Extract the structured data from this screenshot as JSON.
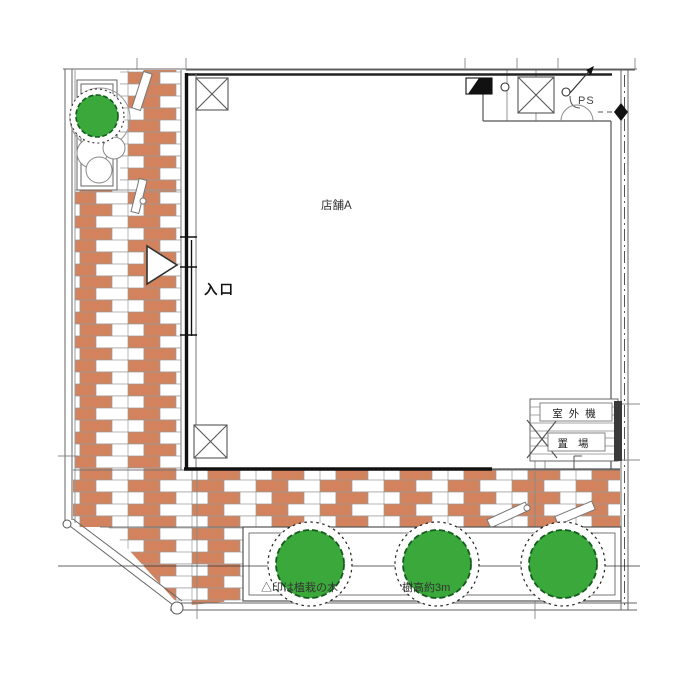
{
  "labels": {
    "room": "店舗A",
    "entrance": "入口",
    "pipe_shaft": "PS",
    "outdoor_unit": "室外機",
    "storage": "置場",
    "note_left": "△印は植栽の木",
    "note_right": "樹高約3m"
  },
  "colors": {
    "brick": "#d2835e",
    "joint": "#9a9a9a",
    "green": "#3aa83a",
    "green_dark": "#145c1e",
    "wall": "#111111",
    "line": "#666666",
    "thin": "#8a8a8a"
  },
  "symbols": [
    "tree-icon",
    "column-icon",
    "entrance-arrow-icon",
    "section-marker-icon",
    "door-swing-arc",
    "diamond-marker-icon",
    "slope-arrow-icon",
    "wheel-stopper",
    "cross-mark"
  ]
}
